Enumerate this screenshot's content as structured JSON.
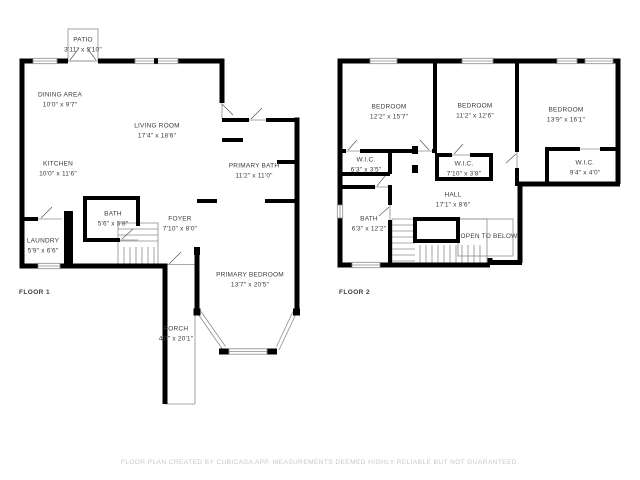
{
  "meta": {
    "type": "floor-plan",
    "colors": {
      "background": "#ffffff",
      "walls": "#000000",
      "thin_lines": "#8c8c8c",
      "labels": "#3b3b3b",
      "footer_text": "#c8c8c8"
    }
  },
  "floor1": {
    "label": "FLOOR 1",
    "rooms": {
      "patio": {
        "name": "PATIO",
        "dims": "3'11\" x 3'10\""
      },
      "dining": {
        "name": "DINING AREA",
        "dims": "10'0\" x 9'7\""
      },
      "living": {
        "name": "LIVING ROOM",
        "dims": "17'4\" x 18'6\""
      },
      "kitchen": {
        "name": "KITCHEN",
        "dims": "10'0\" x 11'6\""
      },
      "primary_bath": {
        "name": "PRIMARY BATH",
        "dims": "11'2\" x 11'0\""
      },
      "bath": {
        "name": "BATH",
        "dims": "5'6\" x 5'8\""
      },
      "foyer": {
        "name": "FOYER",
        "dims": "7'10\" x 8'0\""
      },
      "laundry": {
        "name": "LAUNDRY",
        "dims": "5'9\" x 6'6\""
      },
      "primary_bedroom": {
        "name": "PRIMARY BEDROOM",
        "dims": "13'7\" x 20'5\""
      },
      "porch": {
        "name": "PORCH",
        "dims": "4'0\" x 20'1\""
      }
    }
  },
  "floor2": {
    "label": "FLOOR 2",
    "rooms": {
      "bedroom1": {
        "name": "BEDROOM",
        "dims": "12'2\" x 15'7\""
      },
      "bedroom2": {
        "name": "BEDROOM",
        "dims": "11'2\" x 12'6\""
      },
      "bedroom3": {
        "name": "BEDROOM",
        "dims": "13'9\" x 16'1\""
      },
      "wic1": {
        "name": "W.I.C.",
        "dims": "6'3\" x 3'5\""
      },
      "wic2": {
        "name": "W.I.C.",
        "dims": "7'10\" x 3'8\""
      },
      "wic3": {
        "name": "W.I.C.",
        "dims": "9'4\" x 4'0\""
      },
      "hall": {
        "name": "HALL",
        "dims": "17'1\" x 8'6\""
      },
      "bath": {
        "name": "BATH",
        "dims": "6'3\" x 12'2\""
      },
      "open_to_below": {
        "name": "OPEN TO BELOW"
      }
    }
  },
  "footer": {
    "text": "FLOOR PLAN CREATED BY CUBICASA APP. MEASUREMENTS DEEMED HIGHLY RELIABLE BUT NOT GUARANTEED."
  }
}
